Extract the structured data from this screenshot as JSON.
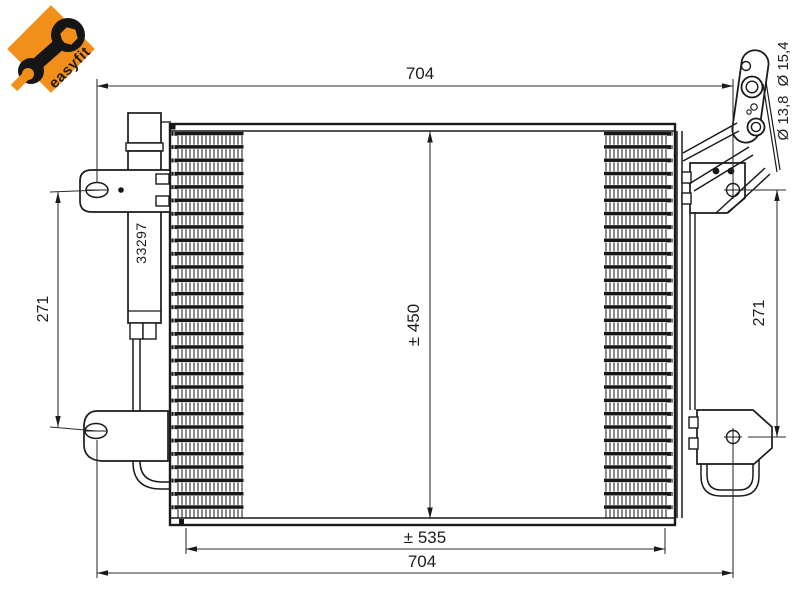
{
  "logo": {
    "brand": "easyfit",
    "accent_color": "#f28e1a"
  },
  "drawing": {
    "part_number": "33297",
    "line_color": "#1a1a1a",
    "dimension_color": "#2b2b2b",
    "dimensions": {
      "overall_width_top": "704",
      "overall_width_bottom": "704",
      "core_width": "± 535",
      "core_height": "± 450",
      "left_bracket_spacing": "271",
      "right_bracket_spacing": "271",
      "port_diameter_small": "Ø 13,8",
      "port_diameter_large": "Ø 15,4"
    }
  }
}
